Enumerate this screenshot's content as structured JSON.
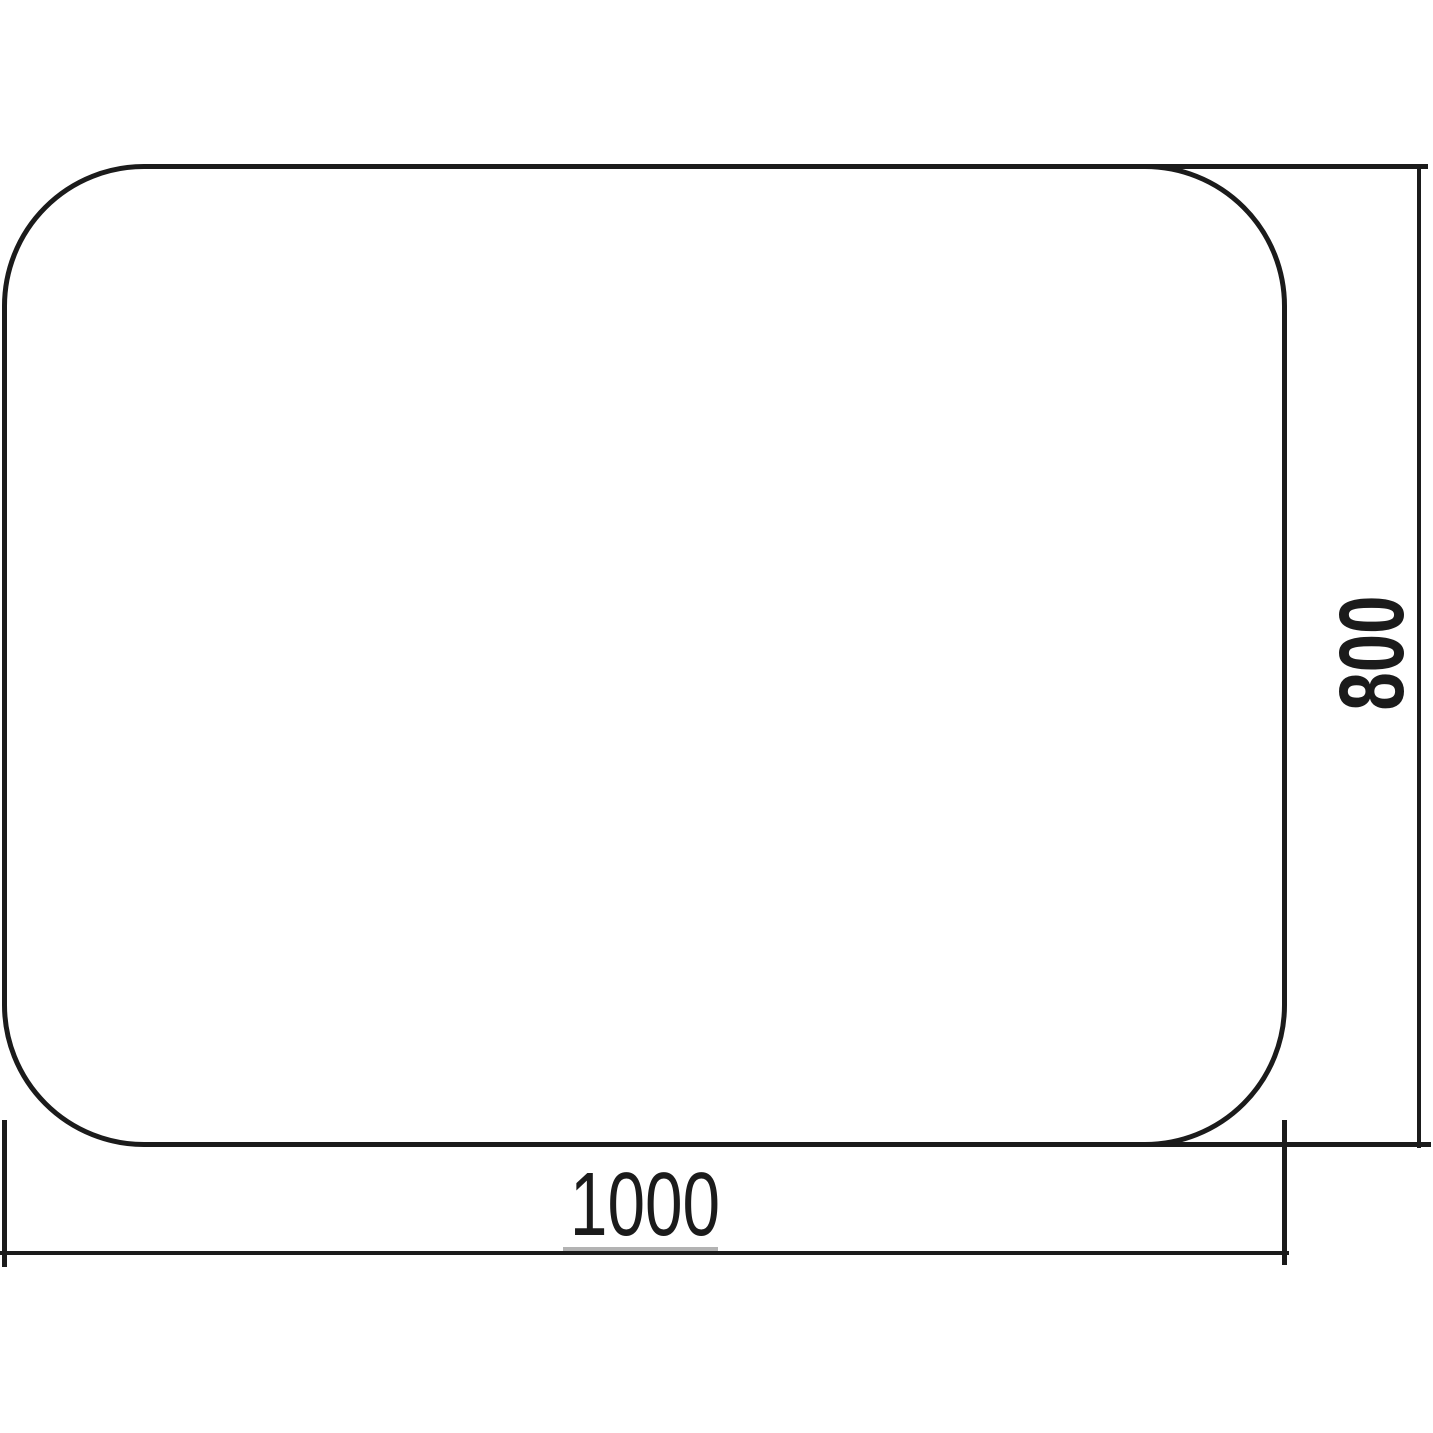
{
  "diagram": {
    "shape": "rounded-rectangle-panel",
    "width_label": "1000",
    "height_label": "800"
  },
  "colors": {
    "line": "#1b1b1b",
    "background": "#ffffff",
    "label_underline_artifact": "#b3b3b3"
  }
}
